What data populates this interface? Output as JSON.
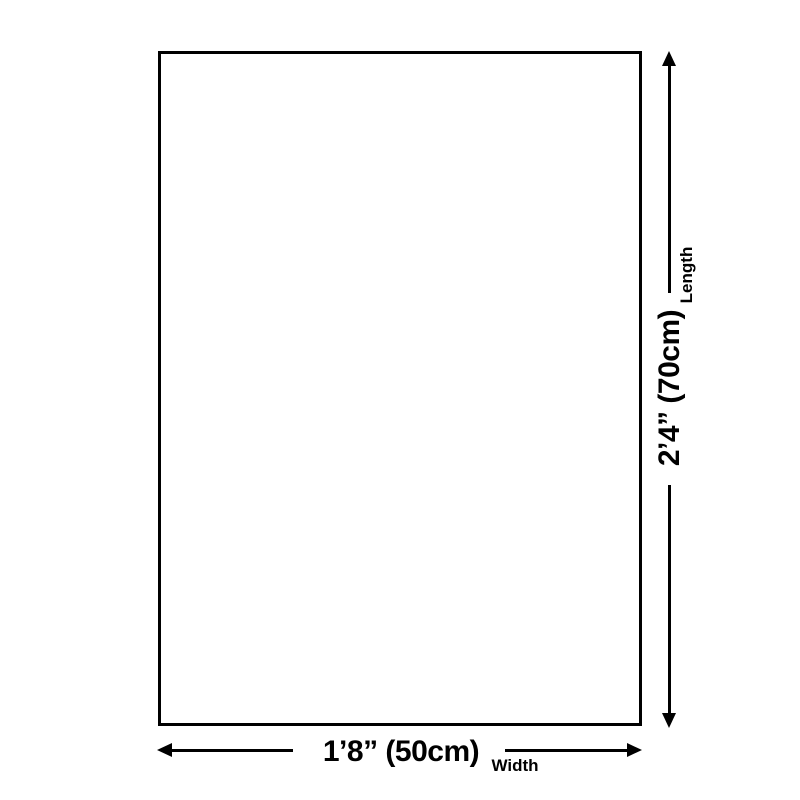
{
  "diagram": {
    "length": {
      "value": "2’4” (70cm)",
      "label": "Length"
    },
    "width": {
      "value": "1’8” (50cm)",
      "label": "Width"
    },
    "colors": {
      "line": "#000000",
      "background": "#ffffff"
    }
  }
}
